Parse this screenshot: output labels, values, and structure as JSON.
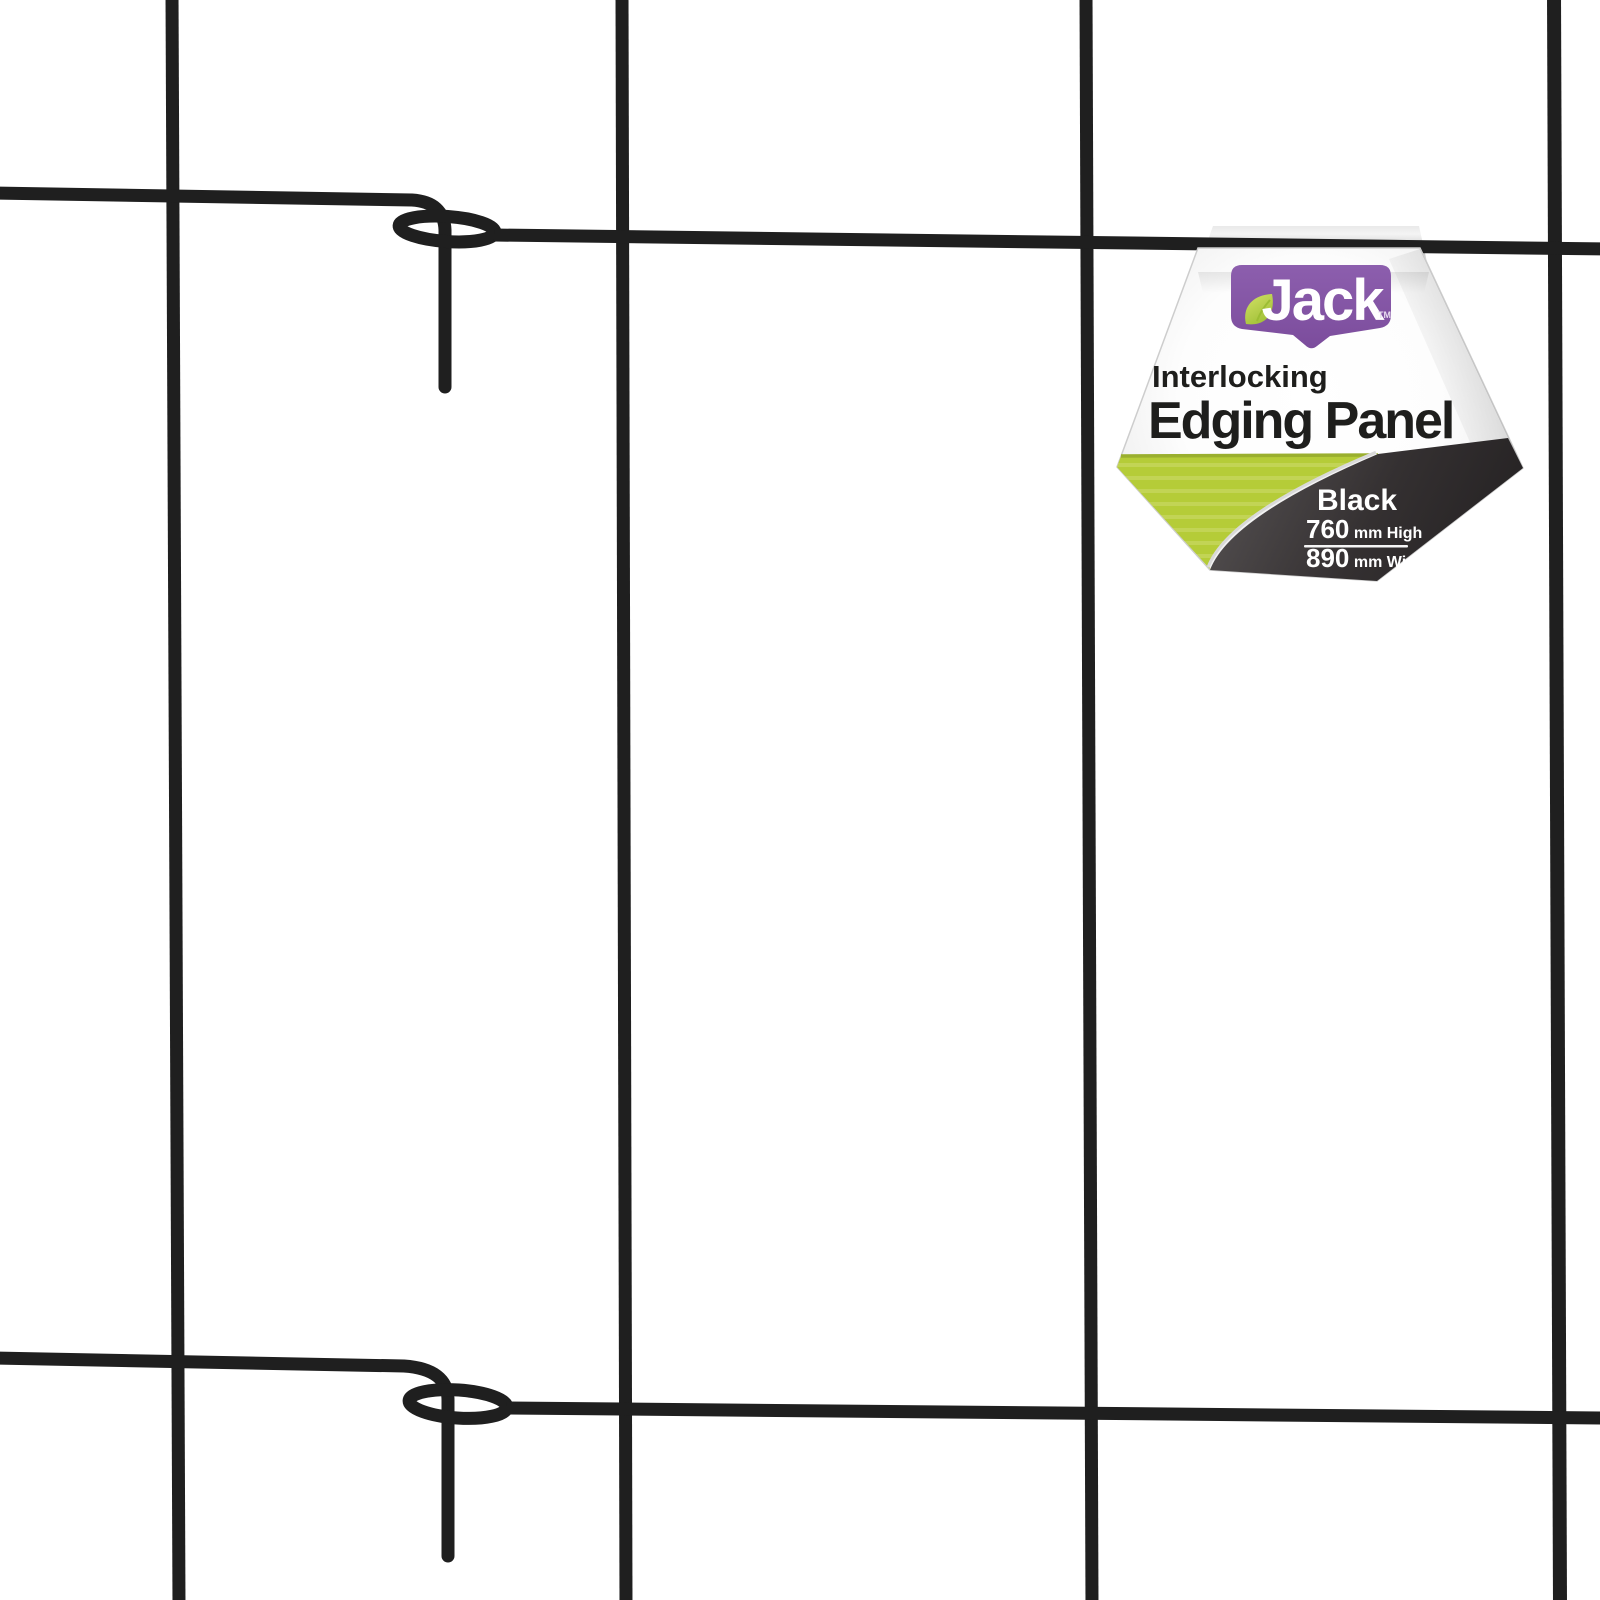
{
  "scene": {
    "background": "#ffffff",
    "wire_color": "#1f1f1f"
  },
  "tag": {
    "brand": "Jack",
    "trademark": "TM",
    "subtitle": "Interlocking",
    "title": "Edging Panel",
    "color_name": "Black",
    "height_value": "760",
    "height_unit": "mm High",
    "width_value": "890",
    "width_unit": "mm Wide",
    "colors": {
      "brand_purple": "#8d5fae",
      "brand_purple_dark": "#7b4c9c",
      "leaf_green_light": "#cede62",
      "leaf_green": "#9cbd33",
      "accent_lime": "#b5cc38",
      "accent_lime_stripe": "#c6d75e",
      "accent_lime_edge": "#9aaf2e",
      "panel_dark_top": "#514d4e",
      "panel_dark_mid": "#343031",
      "panel_dark_bottom": "#242122",
      "silver": "#d9d9d9",
      "text_dark": "#1e1e1c",
      "text_light": "#ffffff"
    }
  }
}
